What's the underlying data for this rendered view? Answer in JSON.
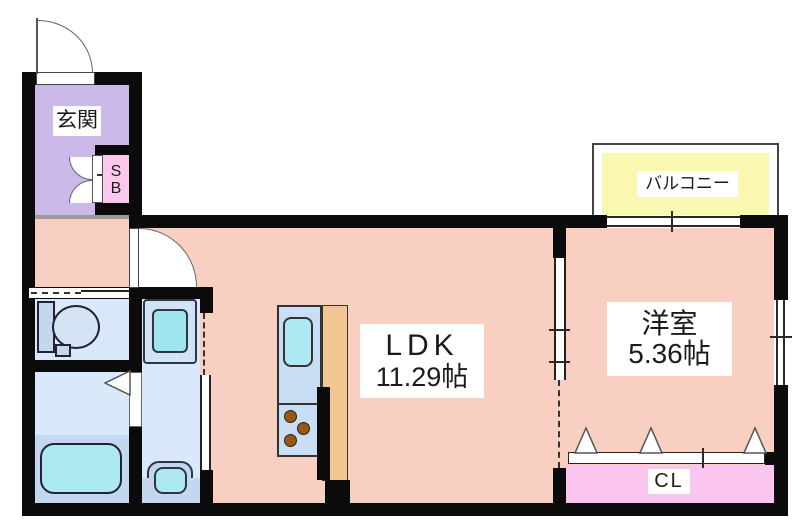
{
  "plan": {
    "type": "floor-plan",
    "rooms": {
      "entrance": {
        "label": "玄関"
      },
      "shoe_box": {
        "line1": "S",
        "line2": "B"
      },
      "ldk": {
        "label": "LDK",
        "size": "11.29帖"
      },
      "western_room": {
        "label": "洋室",
        "size": "5.36帖"
      },
      "balcony": {
        "label": "バルコニー"
      },
      "closet": {
        "label": "CL"
      }
    }
  },
  "colors": {
    "wall": "#0b0b0b",
    "floor-main": "#f8cfc0",
    "floor-entrance": "#cab9e9",
    "pink-sb": "#fac8eb",
    "pink-cl": "#fac6f0",
    "floor-wet": "#dae9fa",
    "floor-wet-dark": "#c3d8f0",
    "counter-blue": "#c9def5",
    "fixture-cyan": "#aee8f2",
    "pan-cyan": "#9fe5ee",
    "balcony-yellow": "#faf7b1",
    "counter-tan": "#f0c691",
    "burner-brown": "#995811",
    "line": "#666666",
    "ink": "#1b1b1b"
  }
}
